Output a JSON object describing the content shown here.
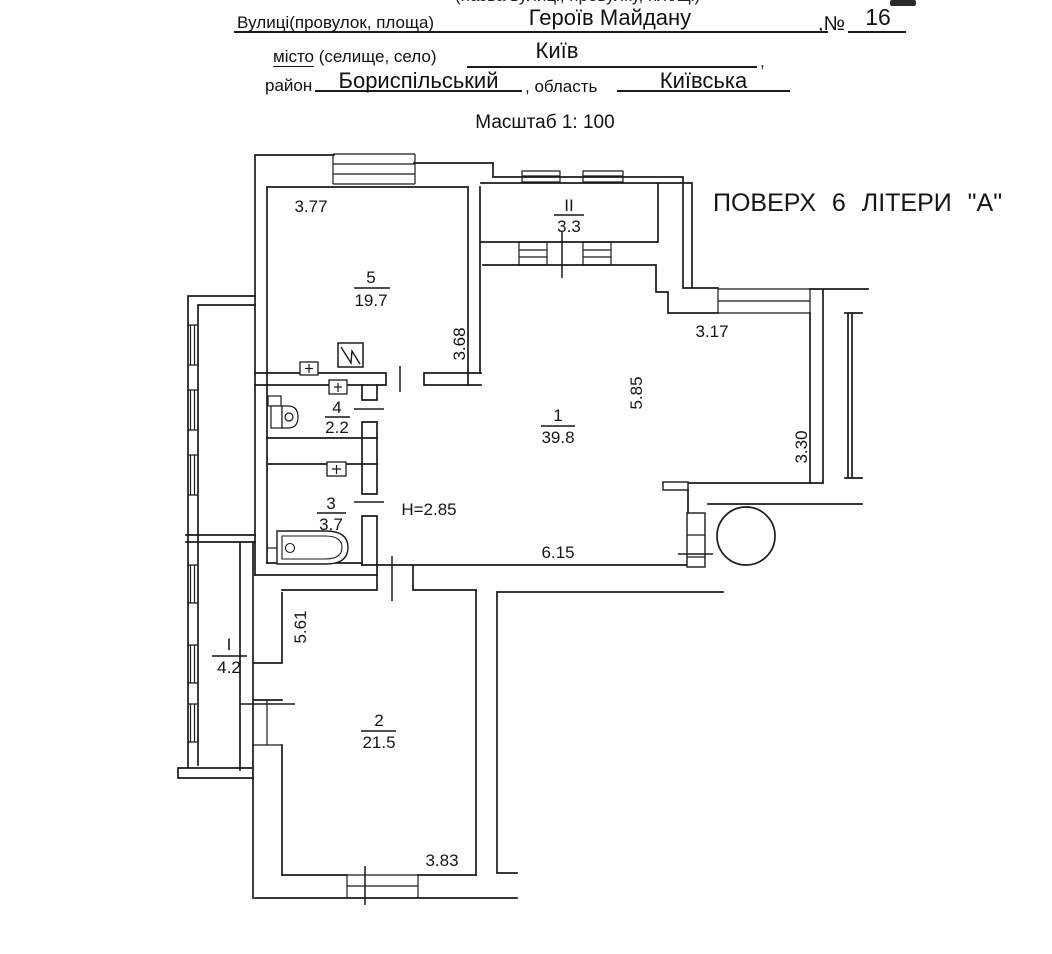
{
  "document": {
    "cutoff_top_text": "(назва вулиці, провулку, площі)",
    "fields": {
      "street_label": "Вулиці(провулок, площа)",
      "street_value": "Героїв Майдану",
      "number_label": ",№",
      "number_value": "16",
      "city_label_underlined": "місто",
      "city_label_rest": " (селище, село)",
      "city_value": "Київ",
      "city_tail": ",",
      "district_label": "район",
      "district_value": "Бориспільський",
      "region_label": ", область",
      "region_value": "Київська"
    },
    "scale_note": "Масштаб 1: 100"
  },
  "plan": {
    "floor_title": "ПОВЕРХ 6 ЛІТЕРИ \"А\"",
    "ceiling_height": "H=2.85",
    "rooms": {
      "room5": {
        "num": "5",
        "area": "19.7"
      },
      "balcony2": {
        "num": "II",
        "area": "3.3"
      },
      "room1": {
        "num": "1",
        "area": "39.8"
      },
      "room4": {
        "num": "4",
        "area": "2.2"
      },
      "room3": {
        "num": "3",
        "area": "3.7"
      },
      "balcony1": {
        "num": "I",
        "area": "4.2"
      },
      "room2": {
        "num": "2",
        "area": "21.5"
      }
    },
    "dimensions": {
      "room5_width": "3.77",
      "room5_height": "3.68",
      "room1_top": "3.17",
      "room1_right": "5.85",
      "room1_far_right": "3.30",
      "room1_bottom": "6.15",
      "room2_height": "5.61",
      "room2_width": "3.83"
    }
  }
}
